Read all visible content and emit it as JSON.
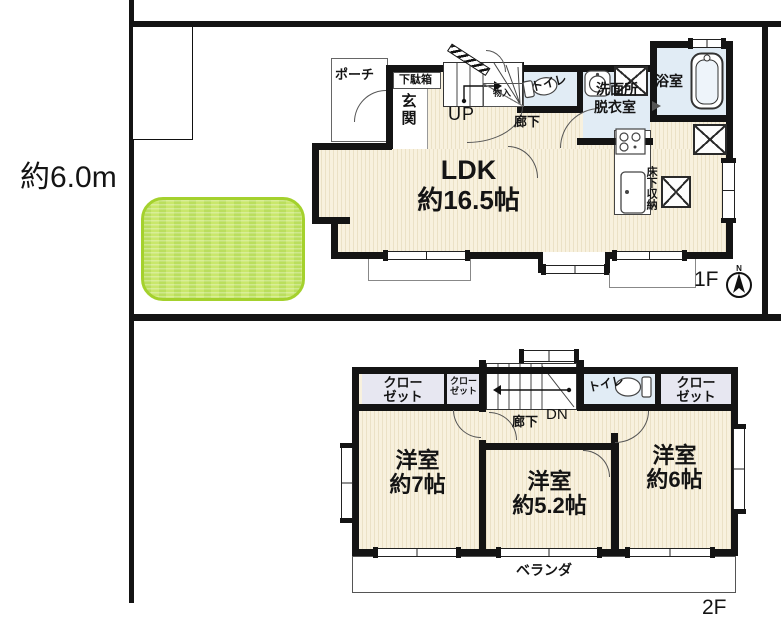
{
  "site": {
    "dimension": "約6.0m"
  },
  "floor1": {
    "label": "1F",
    "compass_n": "N",
    "rooms": {
      "porch": "ポーチ",
      "shoe_cabinet": "下駄箱",
      "entrance": "玄関",
      "stairs_up": "UP",
      "storage": "物入",
      "hallway": "廊下",
      "toilet": "トイレ",
      "washroom_l1": "洗面所",
      "washroom_l2": "脱衣室",
      "bathroom": "浴室",
      "ldk_l1": "LDK",
      "ldk_l2": "約16.5帖",
      "underfloor_storage": "床下収納"
    }
  },
  "floor2": {
    "label": "2F",
    "rooms": {
      "closet_l1": "クロー",
      "closet_l2": "ゼット",
      "stairs_down": "DN",
      "hallway": "廊下",
      "toilet": "トイレ",
      "bedroom_left_l1": "洋室",
      "bedroom_left_l2": "約7帖",
      "bedroom_mid_l1": "洋室",
      "bedroom_mid_l2": "約5.2帖",
      "bedroom_right_l1": "洋室",
      "bedroom_right_l2": "約6帖",
      "veranda": "ベランダ"
    }
  },
  "colors": {
    "wall": "#141414",
    "floor_beige": "#f8f1de",
    "wet_blue": "#e1ecf5",
    "closet_lavender": "#e7e7f1",
    "lawn_green": "#c9e76b",
    "lawn_border": "#a4d12d"
  }
}
